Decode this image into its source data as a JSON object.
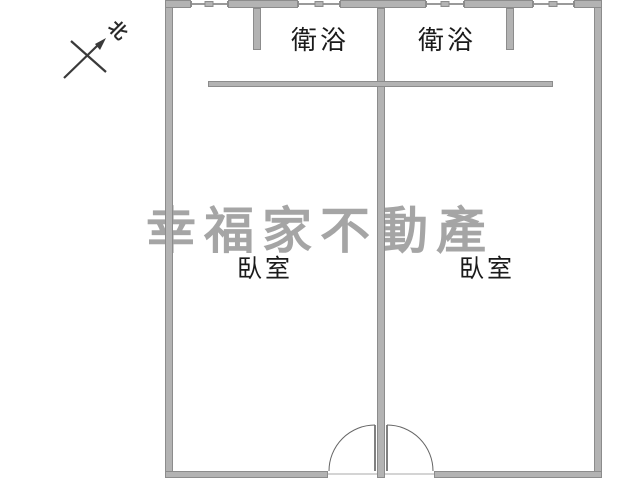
{
  "floorplan": {
    "type": "apartment-floor-plan",
    "compass": {
      "label": "北"
    },
    "watermark": {
      "text": "幸福家不動產",
      "color": "#a5a5a5"
    },
    "rooms": {
      "bathroom_left": {
        "label": "衛浴"
      },
      "bathroom_right": {
        "label": "衛浴"
      },
      "bedroom_left": {
        "label": "臥室"
      },
      "bedroom_right": {
        "label": "臥室"
      }
    },
    "colors": {
      "background": "#ffffff",
      "wall_fill": "#b3b3b3",
      "wall_edge": "#8c8c8c",
      "label_text": "#1a1a1a",
      "watermark": "#a5a5a5",
      "door_line": "#666666"
    }
  }
}
